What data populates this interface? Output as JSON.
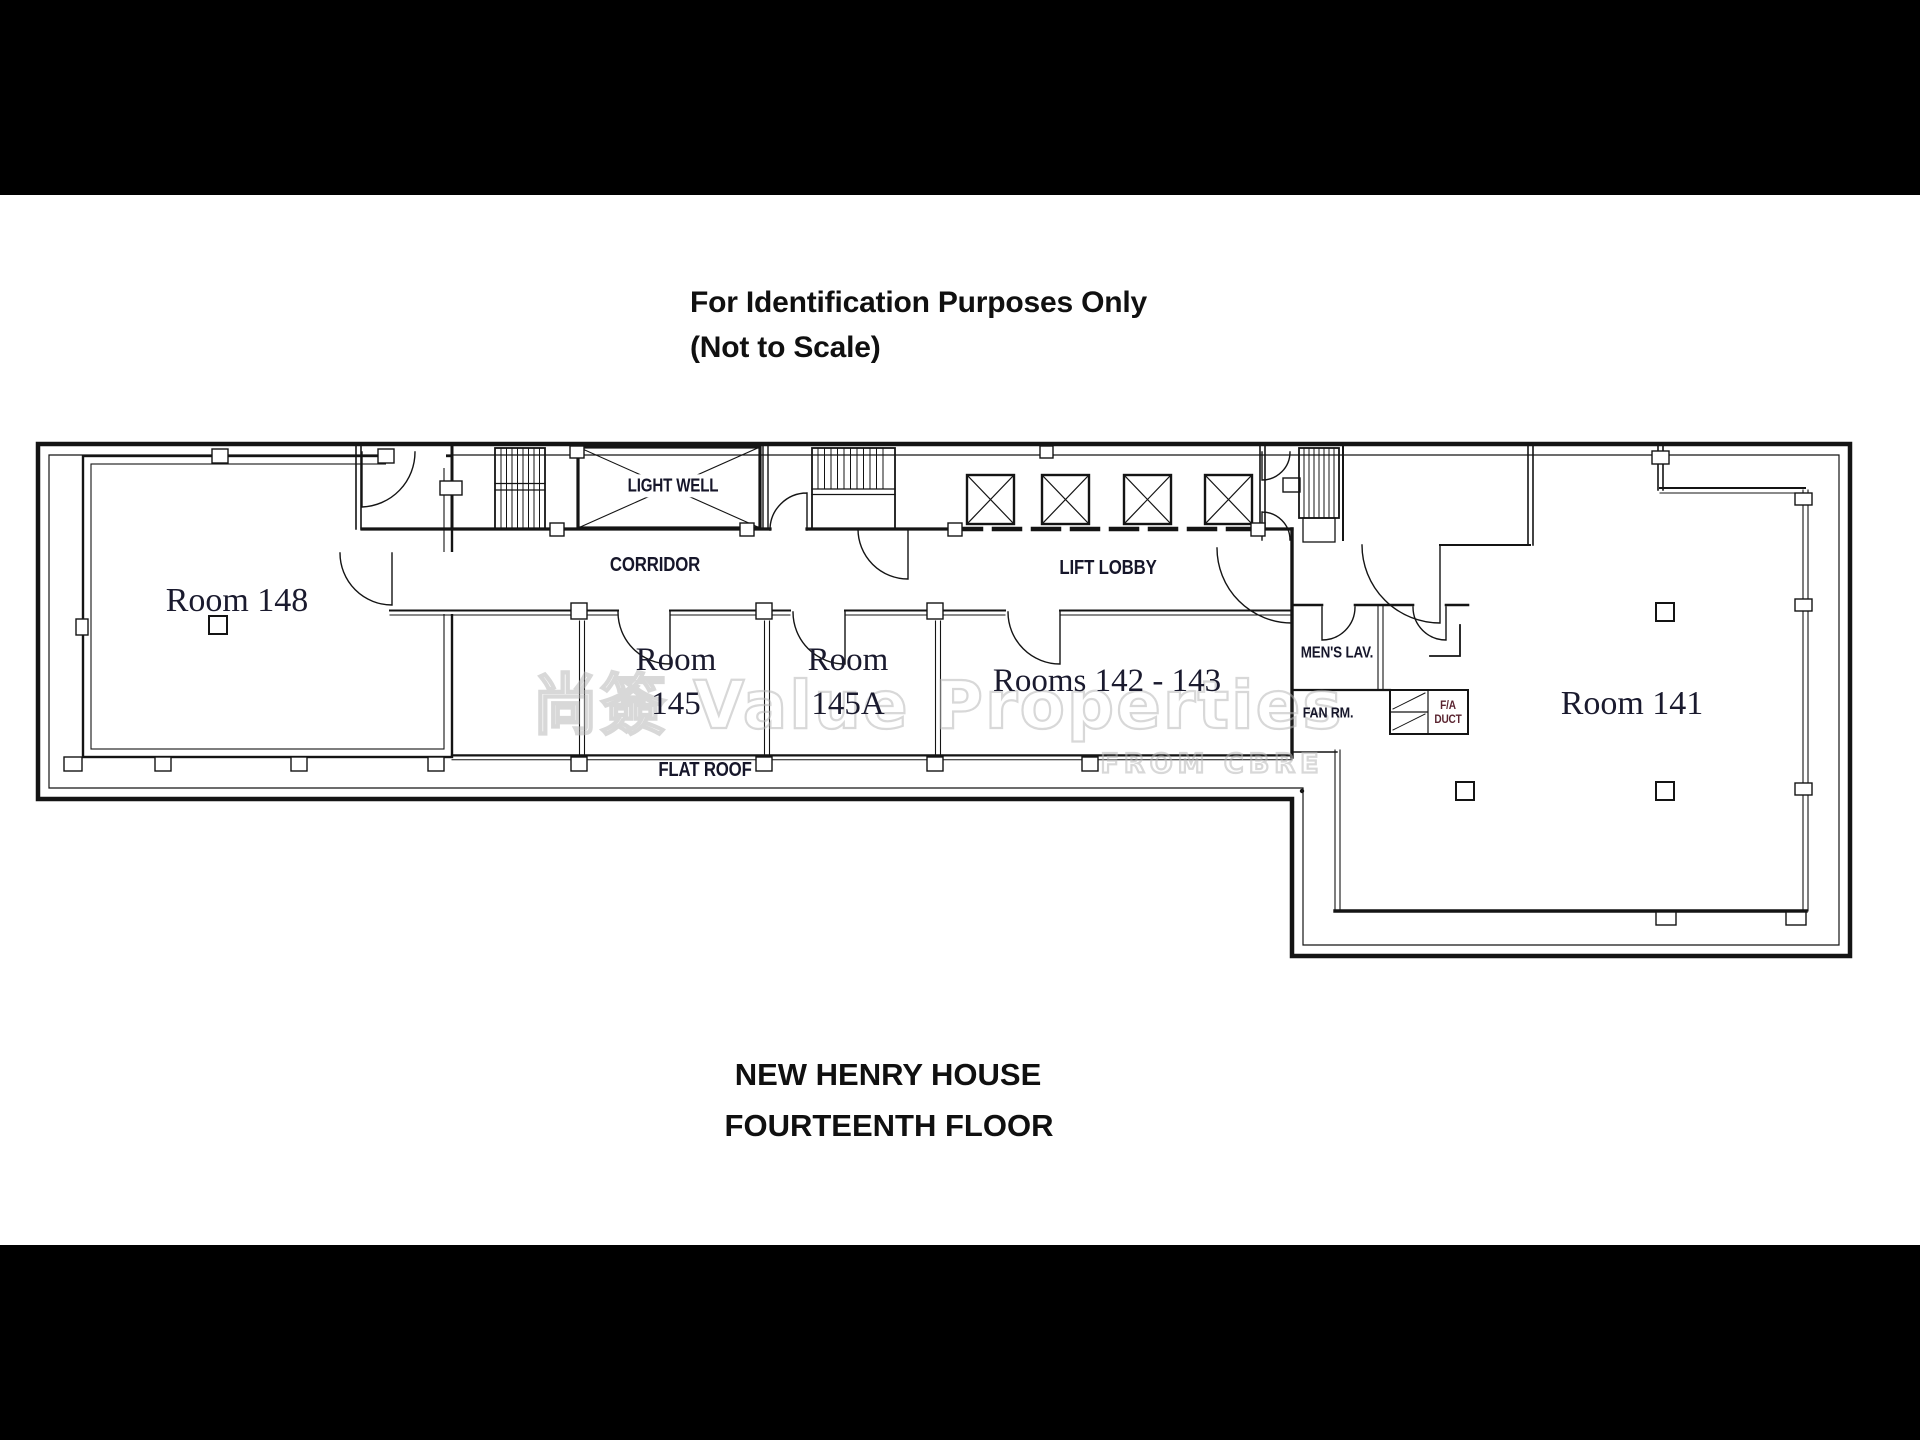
{
  "page": {
    "background": "#000000",
    "paper": "#ffffff",
    "ink": "#141414",
    "label_color": "#1a1a2e",
    "duct_text_color": "#5a2430",
    "watermark_color": "#b9b9b9"
  },
  "titles": {
    "top_line1": "For Identification Purposes Only",
    "top_line2": "(Not to Scale)"
  },
  "footer": {
    "line1": "NEW HENRY HOUSE",
    "line2": "FOURTEENTH FLOOR"
  },
  "watermark": {
    "line1": "尚簽 Value Properties",
    "line2": "FROM CBRE"
  },
  "rooms": {
    "room148": "Room 148",
    "room145": "Room\n145",
    "room145a": "Room\n145A",
    "rooms142_143": "Rooms 142 - 143",
    "room141": "Room 141"
  },
  "areas": {
    "corridor": "CORRIDOR",
    "lift_lobby": "LIFT LOBBY",
    "light_well": "LIGHT WELL",
    "flat_roof": "FLAT ROOF",
    "mens_lav": "MEN'S LAV.",
    "fan_rm": "FAN RM.",
    "fa_duct": "F/A\nDUCT"
  }
}
